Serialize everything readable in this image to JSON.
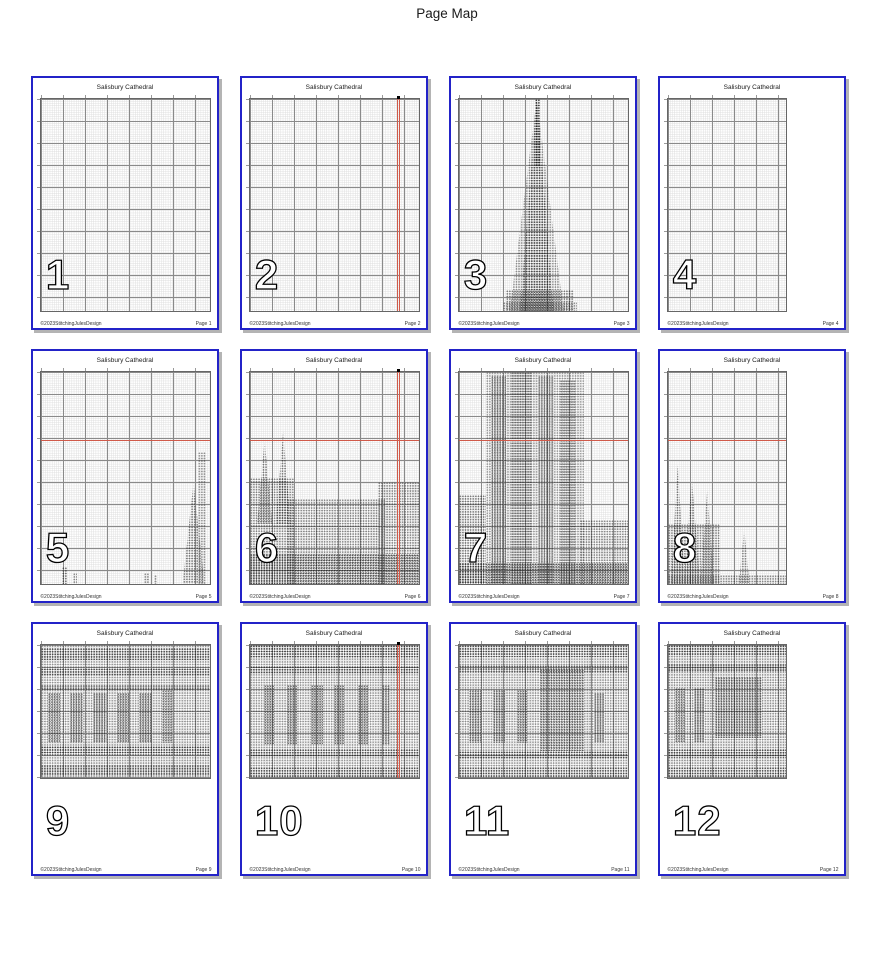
{
  "header": {
    "title": "Page Map"
  },
  "colors": {
    "page_border": "#2323c8",
    "page_shadow": "#b4b4b4",
    "center_line": "#d05a4a",
    "grid_major": "#8a8a8a",
    "grid_minor": "#dcdcdc",
    "stitch": "#141414"
  },
  "pattern_title": "Salisbury Cathedral",
  "copyright": "©2023StitchingJulesDesign",
  "pages": [
    {
      "number": "1",
      "title": "Salisbury Cathedral",
      "footer_left": "©2023StitchingJulesDesign",
      "footer_right": "Page 1",
      "grid": {
        "w": 92.5,
        "h": 85.5
      },
      "centerline_h": null,
      "centerline_v": null,
      "features": []
    },
    {
      "number": "2",
      "title": "Salisbury Cathedral",
      "footer_left": "©2023StitchingJulesDesign",
      "footer_right": "Page 2",
      "grid": {
        "w": 92.5,
        "h": 85.5
      },
      "centerline_h": null,
      "centerline_v": 87,
      "features": []
    },
    {
      "number": "3",
      "title": "Salisbury Cathedral",
      "footer_left": "©2023StitchingJulesDesign",
      "footer_right": "Page 3",
      "grid": {
        "w": 92.5,
        "h": 85.5
      },
      "centerline_h": null,
      "centerline_v": null,
      "features": [
        {
          "s": "tri",
          "x": 30,
          "y": 0,
          "w": 32,
          "h": 100,
          "o": 0.45
        },
        {
          "s": "tri",
          "x": 36,
          "y": 0,
          "w": 20,
          "h": 100,
          "o": 0.6
        },
        {
          "s": "rect",
          "x": 45,
          "y": 0,
          "w": 3,
          "h": 32,
          "o": 0.8
        },
        {
          "s": "rect",
          "x": 28,
          "y": 90,
          "w": 40,
          "h": 10,
          "o": 0.55
        },
        {
          "s": "rect",
          "x": 26,
          "y": 96,
          "w": 44,
          "h": 4,
          "o": 0.5
        }
      ]
    },
    {
      "number": "4",
      "title": "Salisbury Cathedral",
      "footer_left": "©2023StitchingJulesDesign",
      "footer_right": "Page 4",
      "grid": {
        "w": 65,
        "h": 85.5
      },
      "centerline_h": null,
      "centerline_v": null,
      "features": []
    },
    {
      "number": "5",
      "title": "Salisbury Cathedral",
      "footer_left": "©2023StitchingJulesDesign",
      "footer_right": "Page 5",
      "grid": {
        "w": 92.5,
        "h": 85.5
      },
      "centerline_h": 32,
      "centerline_v": null,
      "features": [
        {
          "s": "tri",
          "x": 84,
          "y": 52,
          "w": 13,
          "h": 48,
          "o": 0.55
        },
        {
          "s": "rect",
          "x": 93,
          "y": 38,
          "w": 5,
          "h": 62,
          "o": 0.45
        },
        {
          "s": "rect",
          "x": 12,
          "y": 92,
          "w": 3,
          "h": 8,
          "o": 0.6
        },
        {
          "s": "rect",
          "x": 19,
          "y": 95,
          "w": 2,
          "h": 5,
          "o": 0.5
        },
        {
          "s": "rect",
          "x": 61,
          "y": 95,
          "w": 3,
          "h": 5,
          "o": 0.5
        },
        {
          "s": "rect",
          "x": 67,
          "y": 96,
          "w": 2,
          "h": 4,
          "o": 0.45
        }
      ]
    },
    {
      "number": "6",
      "title": "Salisbury Cathedral",
      "footer_left": "©2023StitchingJulesDesign",
      "footer_right": "Page 6",
      "grid": {
        "w": 92.5,
        "h": 85.5
      },
      "centerline_h": 32,
      "centerline_v": 87,
      "features": [
        {
          "s": "tri",
          "x": 4,
          "y": 32,
          "w": 9,
          "h": 40,
          "o": 0.55
        },
        {
          "s": "tri",
          "x": 15,
          "y": 28,
          "w": 9,
          "h": 44,
          "o": 0.55
        },
        {
          "s": "rect",
          "x": 0,
          "y": 50,
          "w": 26,
          "h": 50,
          "o": 0.5
        },
        {
          "s": "rect",
          "x": 22,
          "y": 60,
          "w": 58,
          "h": 40,
          "o": 0.5
        },
        {
          "s": "rect",
          "x": 76,
          "y": 52,
          "w": 24,
          "h": 48,
          "o": 0.5
        },
        {
          "s": "rect",
          "x": 0,
          "y": 86,
          "w": 100,
          "h": 14,
          "o": 0.65
        }
      ]
    },
    {
      "number": "7",
      "title": "Salisbury Cathedral",
      "footer_left": "©2023StitchingJulesDesign",
      "footer_right": "Page 7",
      "grid": {
        "w": 92.5,
        "h": 85.5
      },
      "centerline_h": 32,
      "centerline_v": null,
      "features": [
        {
          "s": "rect",
          "x": 16,
          "y": 0,
          "w": 58,
          "h": 100,
          "o": 0.4
        },
        {
          "s": "rect",
          "x": 19,
          "y": 2,
          "w": 9,
          "h": 98,
          "o": 0.55
        },
        {
          "s": "rect",
          "x": 31,
          "y": 0,
          "w": 12,
          "h": 100,
          "o": 0.5
        },
        {
          "s": "rect",
          "x": 47,
          "y": 2,
          "w": 9,
          "h": 98,
          "o": 0.5
        },
        {
          "s": "rect",
          "x": 60,
          "y": 4,
          "w": 9,
          "h": 96,
          "o": 0.5
        },
        {
          "s": "rect",
          "x": 0,
          "y": 58,
          "w": 16,
          "h": 42,
          "o": 0.55
        },
        {
          "s": "rect",
          "x": 72,
          "y": 70,
          "w": 28,
          "h": 30,
          "o": 0.5
        },
        {
          "s": "rect",
          "x": 0,
          "y": 90,
          "w": 100,
          "h": 10,
          "o": 0.7
        }
      ]
    },
    {
      "number": "8",
      "title": "Salisbury Cathedral",
      "footer_left": "©2023StitchingJulesDesign",
      "footer_right": "Page 8",
      "grid": {
        "w": 65,
        "h": 85.5
      },
      "centerline_h": 32,
      "centerline_v": null,
      "features": [
        {
          "s": "tri",
          "x": 2,
          "y": 44,
          "w": 12,
          "h": 56,
          "o": 0.55
        },
        {
          "s": "tri",
          "x": 13,
          "y": 50,
          "w": 14,
          "h": 50,
          "o": 0.55
        },
        {
          "s": "tri",
          "x": 27,
          "y": 56,
          "w": 12,
          "h": 44,
          "o": 0.5
        },
        {
          "s": "rect",
          "x": 0,
          "y": 72,
          "w": 44,
          "h": 28,
          "o": 0.5
        },
        {
          "s": "tri",
          "x": 60,
          "y": 74,
          "w": 9,
          "h": 26,
          "o": 0.5
        },
        {
          "s": "rect",
          "x": 0,
          "y": 96,
          "w": 100,
          "h": 4,
          "o": 0.5
        }
      ]
    },
    {
      "number": "9",
      "title": "Salisbury Cathedral",
      "footer_left": "©2023StitchingJulesDesign",
      "footer_right": "Page 9",
      "grid": {
        "w": 92.5,
        "h": 54
      },
      "centerline_h": null,
      "centerline_v": null,
      "features": [
        {
          "s": "rect",
          "x": 0,
          "y": 0,
          "w": 100,
          "h": 100,
          "o": 0.42
        },
        {
          "s": "rect",
          "x": 0,
          "y": 2,
          "w": 100,
          "h": 9,
          "o": 0.6
        },
        {
          "s": "rect",
          "x": 0,
          "y": 17,
          "w": 100,
          "h": 6,
          "o": 0.6
        },
        {
          "s": "rect",
          "x": 0,
          "y": 30,
          "w": 100,
          "h": 4,
          "o": 0.55
        },
        {
          "s": "rect",
          "x": 4,
          "y": 36,
          "w": 7,
          "h": 38,
          "o": 0.6
        },
        {
          "s": "rect",
          "x": 17,
          "y": 36,
          "w": 8,
          "h": 38,
          "o": 0.6
        },
        {
          "s": "rect",
          "x": 31,
          "y": 36,
          "w": 8,
          "h": 38,
          "o": 0.6
        },
        {
          "s": "rect",
          "x": 45,
          "y": 36,
          "w": 7,
          "h": 38,
          "o": 0.6
        },
        {
          "s": "rect",
          "x": 58,
          "y": 36,
          "w": 8,
          "h": 38,
          "o": 0.6
        },
        {
          "s": "rect",
          "x": 72,
          "y": 34,
          "w": 6,
          "h": 40,
          "o": 0.55
        },
        {
          "s": "rect",
          "x": 0,
          "y": 76,
          "w": 100,
          "h": 7,
          "o": 0.65
        },
        {
          "s": "rect",
          "x": 0,
          "y": 90,
          "w": 100,
          "h": 8,
          "o": 0.6
        }
      ]
    },
    {
      "number": "10",
      "title": "Salisbury Cathedral",
      "footer_left": "©2023StitchingJulesDesign",
      "footer_right": "Page 10",
      "grid": {
        "w": 92.5,
        "h": 54
      },
      "centerline_h": null,
      "centerline_v": 87,
      "features": [
        {
          "s": "rect",
          "x": 0,
          "y": 0,
          "w": 100,
          "h": 100,
          "o": 0.42
        },
        {
          "s": "rect",
          "x": 0,
          "y": 0,
          "w": 100,
          "h": 10,
          "o": 0.65
        },
        {
          "s": "rect",
          "x": 0,
          "y": 16,
          "w": 100,
          "h": 6,
          "o": 0.6
        },
        {
          "s": "rect",
          "x": 8,
          "y": 30,
          "w": 6,
          "h": 45,
          "o": 0.6
        },
        {
          "s": "rect",
          "x": 22,
          "y": 30,
          "w": 6,
          "h": 45,
          "o": 0.6
        },
        {
          "s": "rect",
          "x": 36,
          "y": 30,
          "w": 7,
          "h": 45,
          "o": 0.6
        },
        {
          "s": "rect",
          "x": 50,
          "y": 30,
          "w": 6,
          "h": 45,
          "o": 0.6
        },
        {
          "s": "rect",
          "x": 64,
          "y": 30,
          "w": 6,
          "h": 45,
          "o": 0.6
        },
        {
          "s": "rect",
          "x": 78,
          "y": 30,
          "w": 5,
          "h": 45,
          "o": 0.55
        },
        {
          "s": "rect",
          "x": 0,
          "y": 78,
          "w": 100,
          "h": 6,
          "o": 0.6
        },
        {
          "s": "rect",
          "x": 0,
          "y": 92,
          "w": 100,
          "h": 8,
          "o": 0.6
        }
      ]
    },
    {
      "number": "11",
      "title": "Salisbury Cathedral",
      "footer_left": "©2023StitchingJulesDesign",
      "footer_right": "Page 11",
      "grid": {
        "w": 92.5,
        "h": 54
      },
      "centerline_h": null,
      "centerline_v": null,
      "features": [
        {
          "s": "rect",
          "x": 0,
          "y": 0,
          "w": 100,
          "h": 100,
          "o": 0.42
        },
        {
          "s": "rect",
          "x": 0,
          "y": 0,
          "w": 100,
          "h": 9,
          "o": 0.6
        },
        {
          "s": "rect",
          "x": 0,
          "y": 15,
          "w": 100,
          "h": 6,
          "o": 0.58
        },
        {
          "s": "rect",
          "x": 48,
          "y": 18,
          "w": 26,
          "h": 62,
          "o": 0.6
        },
        {
          "s": "rect",
          "x": 6,
          "y": 34,
          "w": 7,
          "h": 40,
          "o": 0.58
        },
        {
          "s": "rect",
          "x": 20,
          "y": 34,
          "w": 7,
          "h": 40,
          "o": 0.58
        },
        {
          "s": "rect",
          "x": 34,
          "y": 34,
          "w": 7,
          "h": 40,
          "o": 0.58
        },
        {
          "s": "rect",
          "x": 80,
          "y": 36,
          "w": 6,
          "h": 38,
          "o": 0.55
        },
        {
          "s": "rect",
          "x": 0,
          "y": 80,
          "w": 100,
          "h": 6,
          "o": 0.62
        },
        {
          "s": "rect",
          "x": 0,
          "y": 92,
          "w": 100,
          "h": 8,
          "o": 0.55
        }
      ]
    },
    {
      "number": "12",
      "title": "Salisbury Cathedral",
      "footer_left": "©2023StitchingJulesDesign",
      "footer_right": "Page 12",
      "grid": {
        "w": 65,
        "h": 54
      },
      "centerline_h": null,
      "centerline_v": null,
      "features": [
        {
          "s": "rect",
          "x": 0,
          "y": 0,
          "w": 100,
          "h": 100,
          "o": 0.45
        },
        {
          "s": "rect",
          "x": 0,
          "y": 0,
          "w": 100,
          "h": 8,
          "o": 0.62
        },
        {
          "s": "rect",
          "x": 0,
          "y": 14,
          "w": 100,
          "h": 6,
          "o": 0.6
        },
        {
          "s": "rect",
          "x": 40,
          "y": 24,
          "w": 40,
          "h": 46,
          "o": 0.6
        },
        {
          "s": "rect",
          "x": 6,
          "y": 32,
          "w": 8,
          "h": 42,
          "o": 0.58
        },
        {
          "s": "rect",
          "x": 22,
          "y": 32,
          "w": 8,
          "h": 42,
          "o": 0.58
        },
        {
          "s": "rect",
          "x": 0,
          "y": 78,
          "w": 100,
          "h": 7,
          "o": 0.62
        },
        {
          "s": "rect",
          "x": 0,
          "y": 92,
          "w": 100,
          "h": 8,
          "o": 0.55
        }
      ]
    }
  ]
}
